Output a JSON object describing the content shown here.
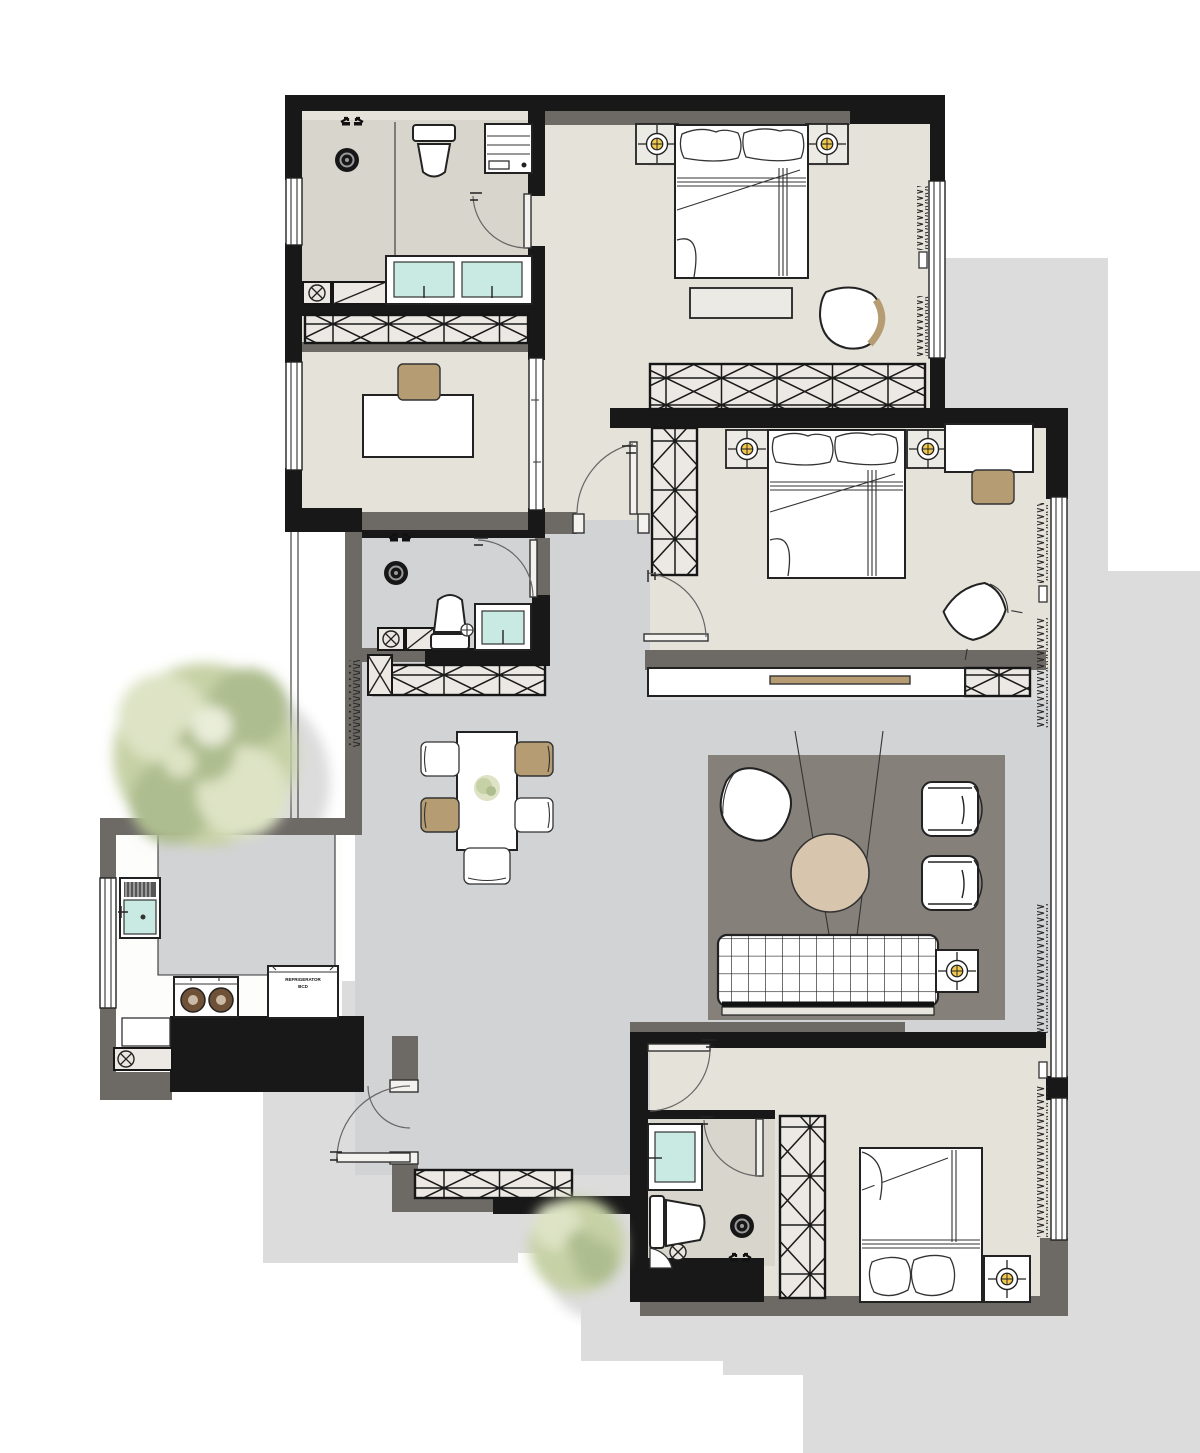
{
  "labels": {
    "fridge_line1": "REFRIGERATOR",
    "fridge_line2": "BCD"
  },
  "colors": {
    "wall": "#181818",
    "wall-gray": "#6d6a66",
    "floor-room": "#e5e2da",
    "floor-bath": "#d8d5cc",
    "floor-hall": "#d2d3d5",
    "rug": "#85817a",
    "hatch": "#ece8e3",
    "wood": "#b59c72",
    "glass": "#c9eae2",
    "light": "#f2c84e",
    "tree": "#c6d1a6",
    "tree-dark": "#aebd8f",
    "tree-light": "#dde3c4",
    "shadow": "#dcdcdc"
  }
}
